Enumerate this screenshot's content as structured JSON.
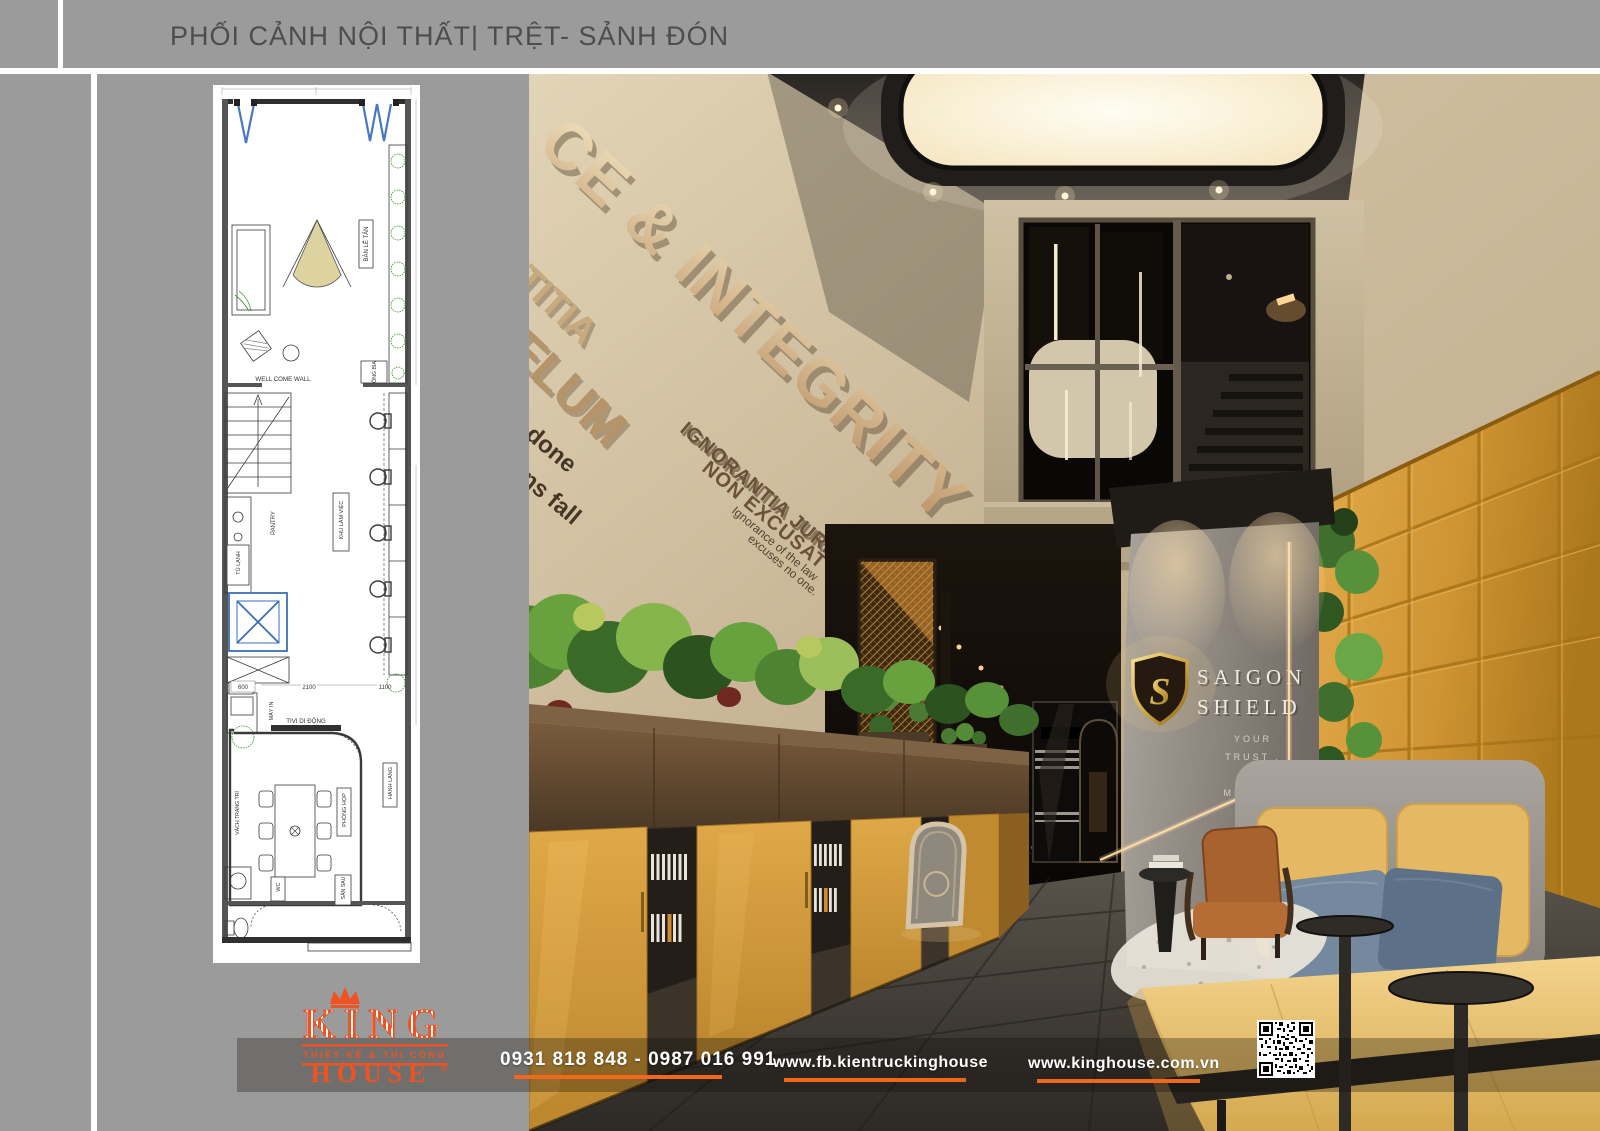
{
  "header": {
    "title": "PHỐI CẢNH NỘI THẤT| TRỆT- SẢNH ĐÓN"
  },
  "plan": {
    "labels": {
      "reception_desk": "BÀN LỄ TÂN",
      "welcome_wall": "WELL COME WALL",
      "beer_shelf": "ỐNG BIA",
      "pantry": "PANTRY",
      "fridge": "TỦ LẠNH",
      "work_area": "KHU LÀM VIỆC",
      "printer": "MÁY IN",
      "mobile_tv": "TIVI DI ĐỘNG",
      "meeting_room": "PHÒNG HỌP",
      "corridor": "HÀNH LANG",
      "decor_partition": "VÁCH TRANG TRÍ",
      "wc": "WC",
      "backyard": "SÂN SAU"
    },
    "dims": [
      "600",
      "2100",
      "1100"
    ]
  },
  "render": {
    "wall_quote_main": "CE & INTEGRITY",
    "wall_quote_frag1": "TITIA",
    "wall_quote_frag2": "ELUM",
    "wall_quote_frag3": "e done",
    "wall_quote_frag4": "vens fall",
    "latin_line1": "IGNORANTIA JURIS",
    "latin_line2": "NON EXCUSAT",
    "latin_sub1": "Ignorance of the law",
    "latin_sub2": "excuses no one.",
    "brand_monogram": "S",
    "brand_line1": "SAIGON",
    "brand_line2": "SHIELD",
    "brand_tagline": [
      "YOUR",
      "TRUST .",
      "OUR",
      "MISSION"
    ]
  },
  "footer": {
    "logo_name": "KING",
    "logo_tagline": "THIẾT KẾ & THI CÔNG",
    "logo_name2": "HOUSE",
    "logo_reg": "®",
    "phone": "0931 818 848 - 0987 016 991",
    "facebook": "www.fb.kientruckinghouse",
    "website": "www.kinghouse.com.vn"
  },
  "colors": {
    "accent": "#EF5322",
    "gold": "#D9A93C",
    "panel_gray": "#9B9B9B"
  }
}
